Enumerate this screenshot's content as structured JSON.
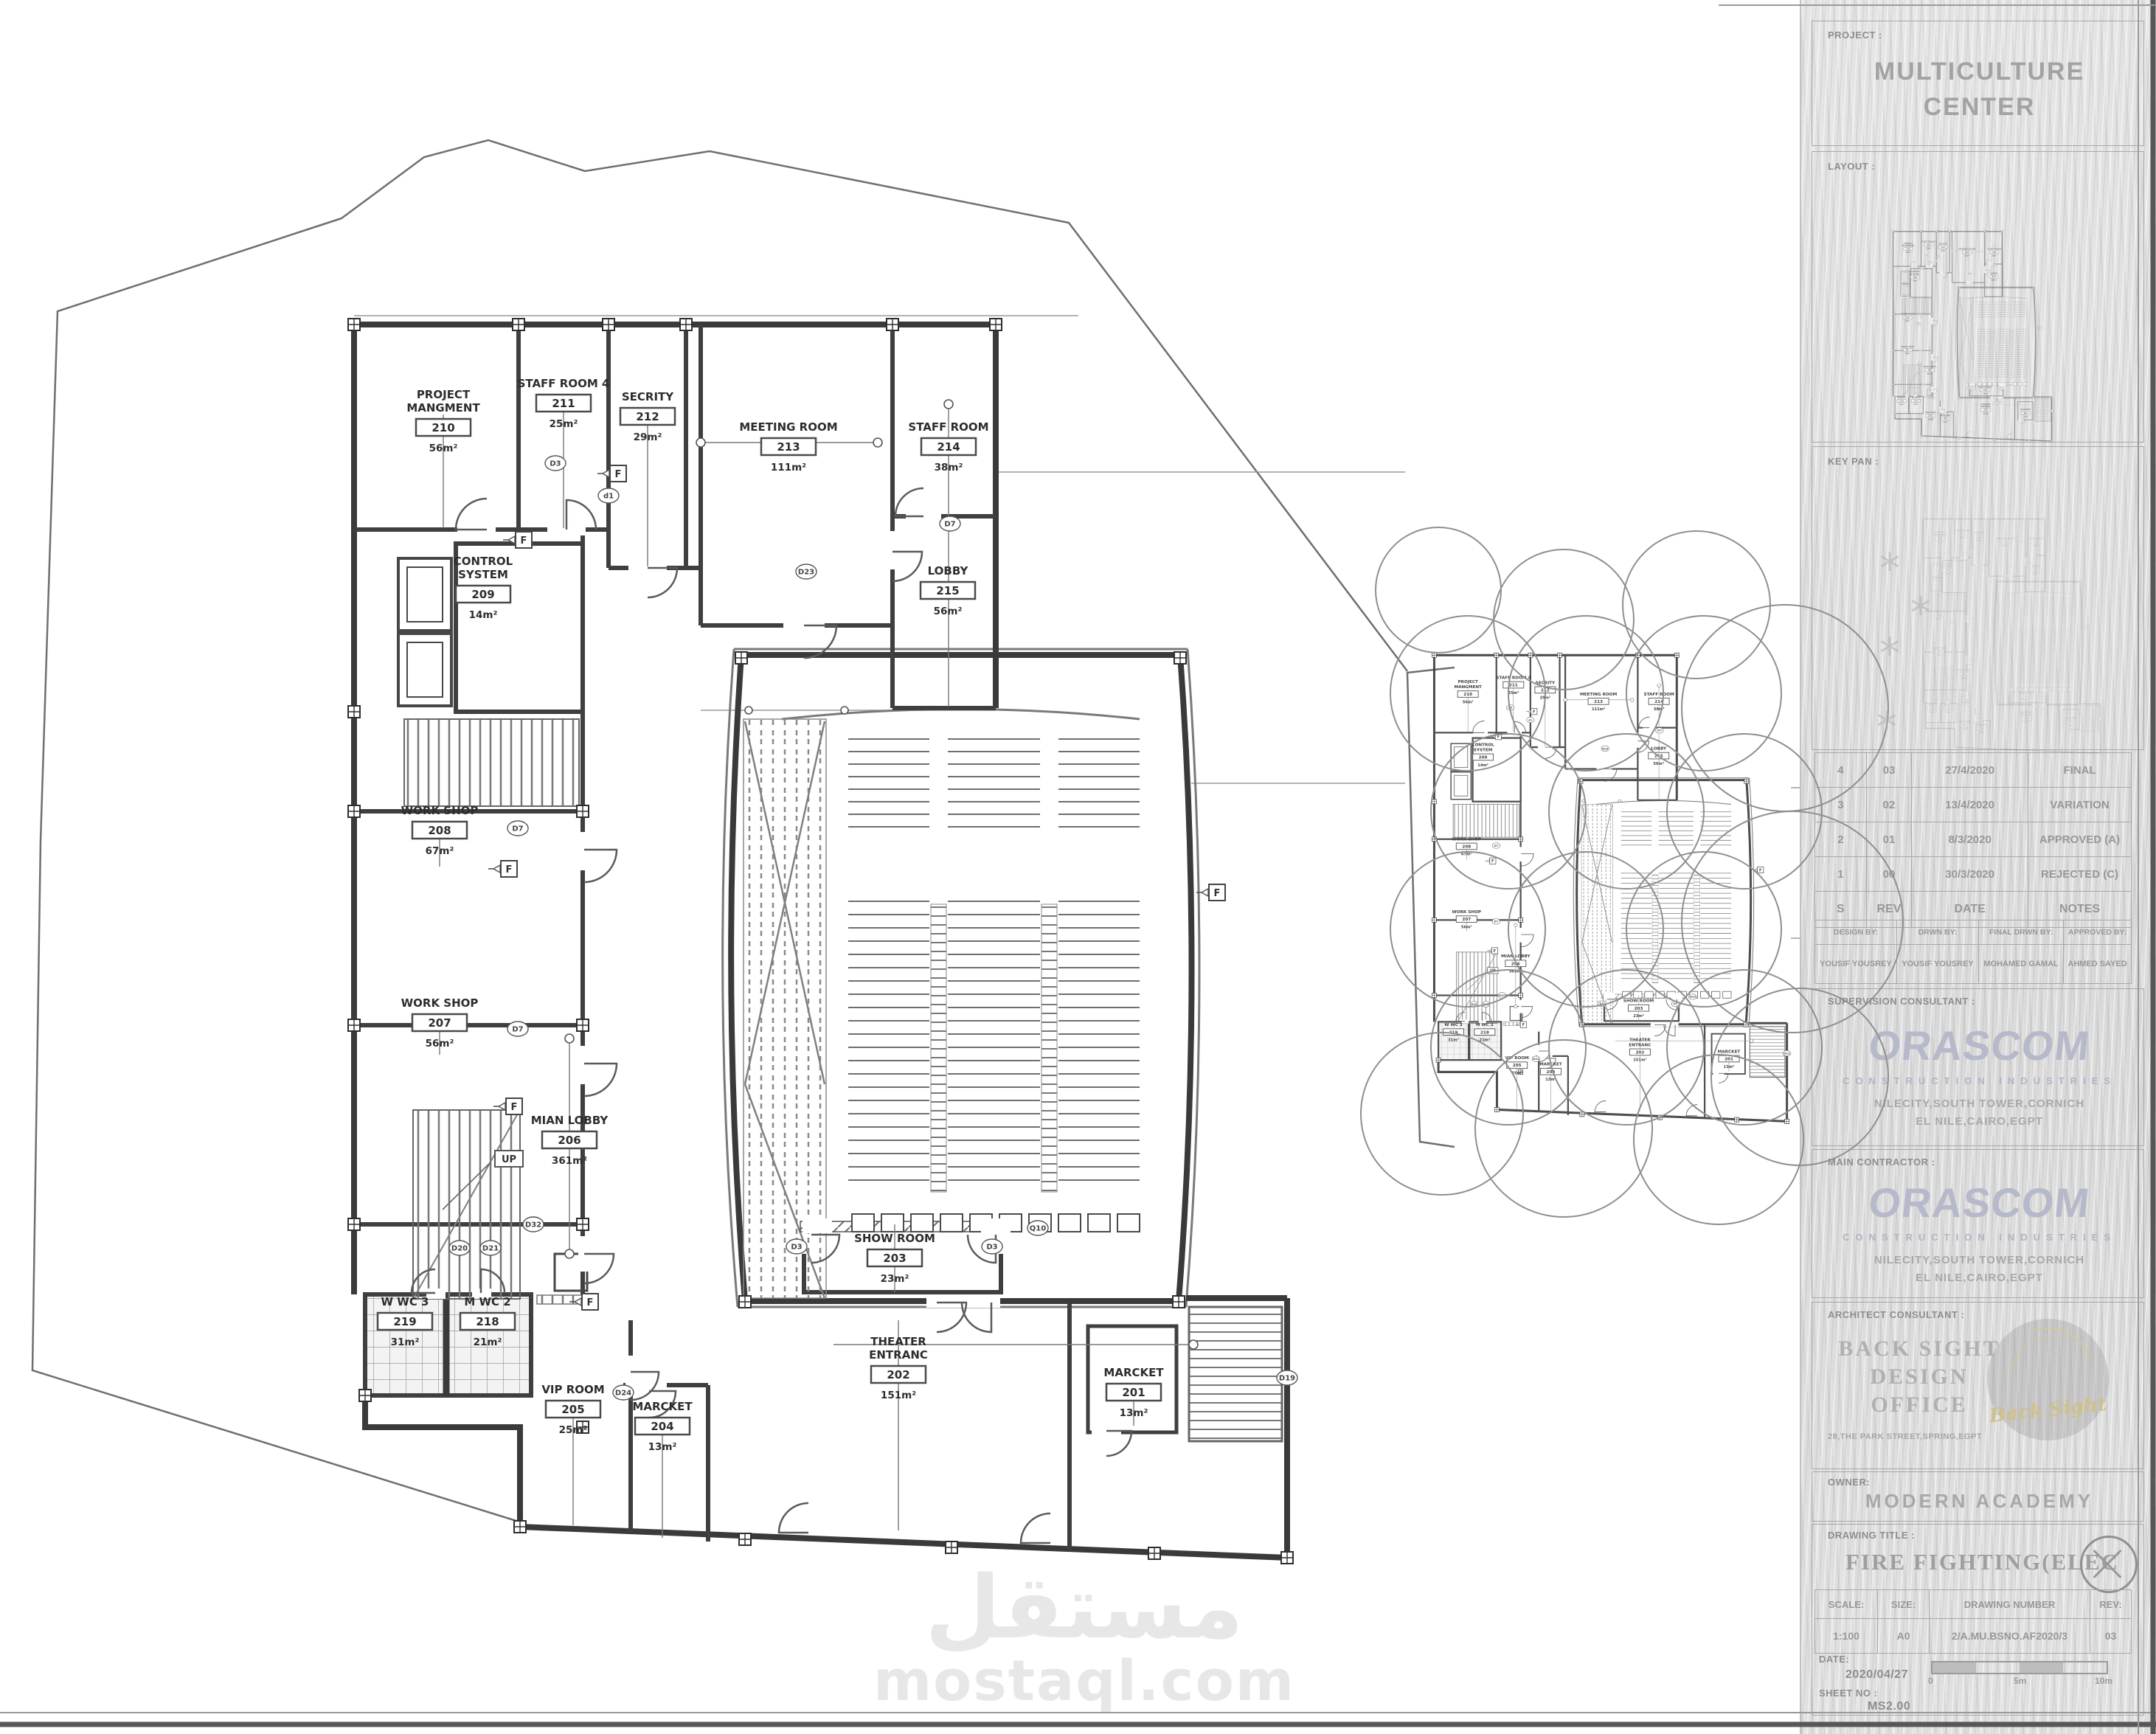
{
  "watermark": {
    "line1": "مستقل",
    "line2": "mostaql.com"
  },
  "plan": {
    "up_label": "UP",
    "fire_symbol": "F",
    "door_tags": [
      "D3",
      "d1",
      "D23",
      "D7",
      "D7",
      "D7",
      "D32",
      "D20",
      "D21",
      "D24",
      "D3",
      "D3",
      "Q10",
      "D19"
    ],
    "rooms": [
      {
        "name_l1": "PROJECT",
        "name_l2": "MANGMENT",
        "number": "210",
        "area": "56m²"
      },
      {
        "name_l1": "STAFF ROOM 4",
        "name_l2": "",
        "number": "211",
        "area": "25m²"
      },
      {
        "name_l1": "SECRITY",
        "name_l2": "",
        "number": "212",
        "area": "29m²"
      },
      {
        "name_l1": "MEETING ROOM",
        "name_l2": "",
        "number": "213",
        "area": "111m²"
      },
      {
        "name_l1": "STAFF ROOM",
        "name_l2": "",
        "number": "214",
        "area": "38m²"
      },
      {
        "name_l1": "LOBBY",
        "name_l2": "",
        "number": "215",
        "area": "56m²"
      },
      {
        "name_l1": "CONTROL",
        "name_l2": "SYSTEM",
        "number": "209",
        "area": "14m²"
      },
      {
        "name_l1": "WORK SHOP",
        "name_l2": "",
        "number": "208",
        "area": "67m²"
      },
      {
        "name_l1": "WORK SHOP",
        "name_l2": "",
        "number": "207",
        "area": "56m²"
      },
      {
        "name_l1": "MIAN LOBBY",
        "name_l2": "",
        "number": "206",
        "area": "361m²"
      },
      {
        "name_l1": "W WC 3",
        "name_l2": "",
        "number": "219",
        "area": "31m²"
      },
      {
        "name_l1": "M WC 2",
        "name_l2": "",
        "number": "218",
        "area": "21m²"
      },
      {
        "name_l1": "VIP ROOM",
        "name_l2": "",
        "number": "205",
        "area": "25m²"
      },
      {
        "name_l1": "MARCKET",
        "name_l2": "",
        "number": "204",
        "area": "13m²"
      },
      {
        "name_l1": "SHOW ROOM",
        "name_l2": "",
        "number": "203",
        "area": "23m²"
      },
      {
        "name_l1": "THEATER",
        "name_l2": "ENTRANC",
        "number": "202",
        "area": "151m²"
      },
      {
        "name_l1": "MARCKET",
        "name_l2": "",
        "number": "201",
        "area": "13m²"
      }
    ]
  },
  "titleblock": {
    "project": {
      "label": "PROJECT :",
      "name_l1": "MULTICULTURE",
      "name_l2": "CENTER"
    },
    "layout": {
      "label": "LAYOUT :"
    },
    "keyplan": {
      "label": "KEY PAN :"
    },
    "revisions": {
      "header": [
        "S",
        "REV",
        "DATE",
        "NOTES"
      ],
      "rows": [
        [
          "4",
          "03",
          "27/4/2020",
          "FINAL"
        ],
        [
          "3",
          "02",
          "13/4/2020",
          "VARIATION"
        ],
        [
          "2",
          "01",
          "8/3/2020",
          "APPROVED (A)"
        ],
        [
          "1",
          "00",
          "30/3/2020",
          "REJECTED (C)"
        ]
      ]
    },
    "signatures": {
      "labels": [
        "DESIGN BY:",
        "DRWN BY:",
        "FINAL DRWN BY:",
        "APPROVED BY:"
      ],
      "names": [
        "YOUSIF YOUSREY",
        "YOUSIF YOUSREY",
        "MOHAMED GAMAL",
        "AHMED SAYED"
      ]
    },
    "supervision_label": "SUPERVISION CONSULTANT :",
    "contractor_label": "MAIN CONTRACTOR :",
    "orascom": {
      "name": "ORASCOM",
      "sub": "CONSTRUCTION INDUSTRIES",
      "addr1": "NILECITY,SOUTH TOWER,CORNICH",
      "addr2": "EL NILE,CAIRO,EGPT"
    },
    "architect": {
      "label": "ARCHITECT CONSULTANT :",
      "name_l1": "BACK SIGHT",
      "name_l2": "DESIGN",
      "name_l3": "OFFICE",
      "address": "28,THE PARK STREET,SPRING,EGPT",
      "stamp": "Back Sight"
    },
    "owner": {
      "label": "OWNER:",
      "name": "MODERN ACADEMY"
    },
    "drawing": {
      "label": "DRAWING TITLE :",
      "title": "FIRE FIGHTING(ELEC"
    },
    "meta": {
      "scale_label": "SCALE:",
      "scale": "1:100",
      "size_label": "SIZE:",
      "size": "A0",
      "number_label": "DRAWING NUMBER",
      "number": "2/A.MU.BSNO.AF2020/3",
      "rev_label": "REV:",
      "rev": "03"
    },
    "date": {
      "label": "DATE:",
      "value": "2020/04/27"
    },
    "sheet_no": {
      "label": "SHEET NO :",
      "value": "MS2.00"
    },
    "scalebar": [
      "0",
      "5m",
      "10m"
    ]
  }
}
